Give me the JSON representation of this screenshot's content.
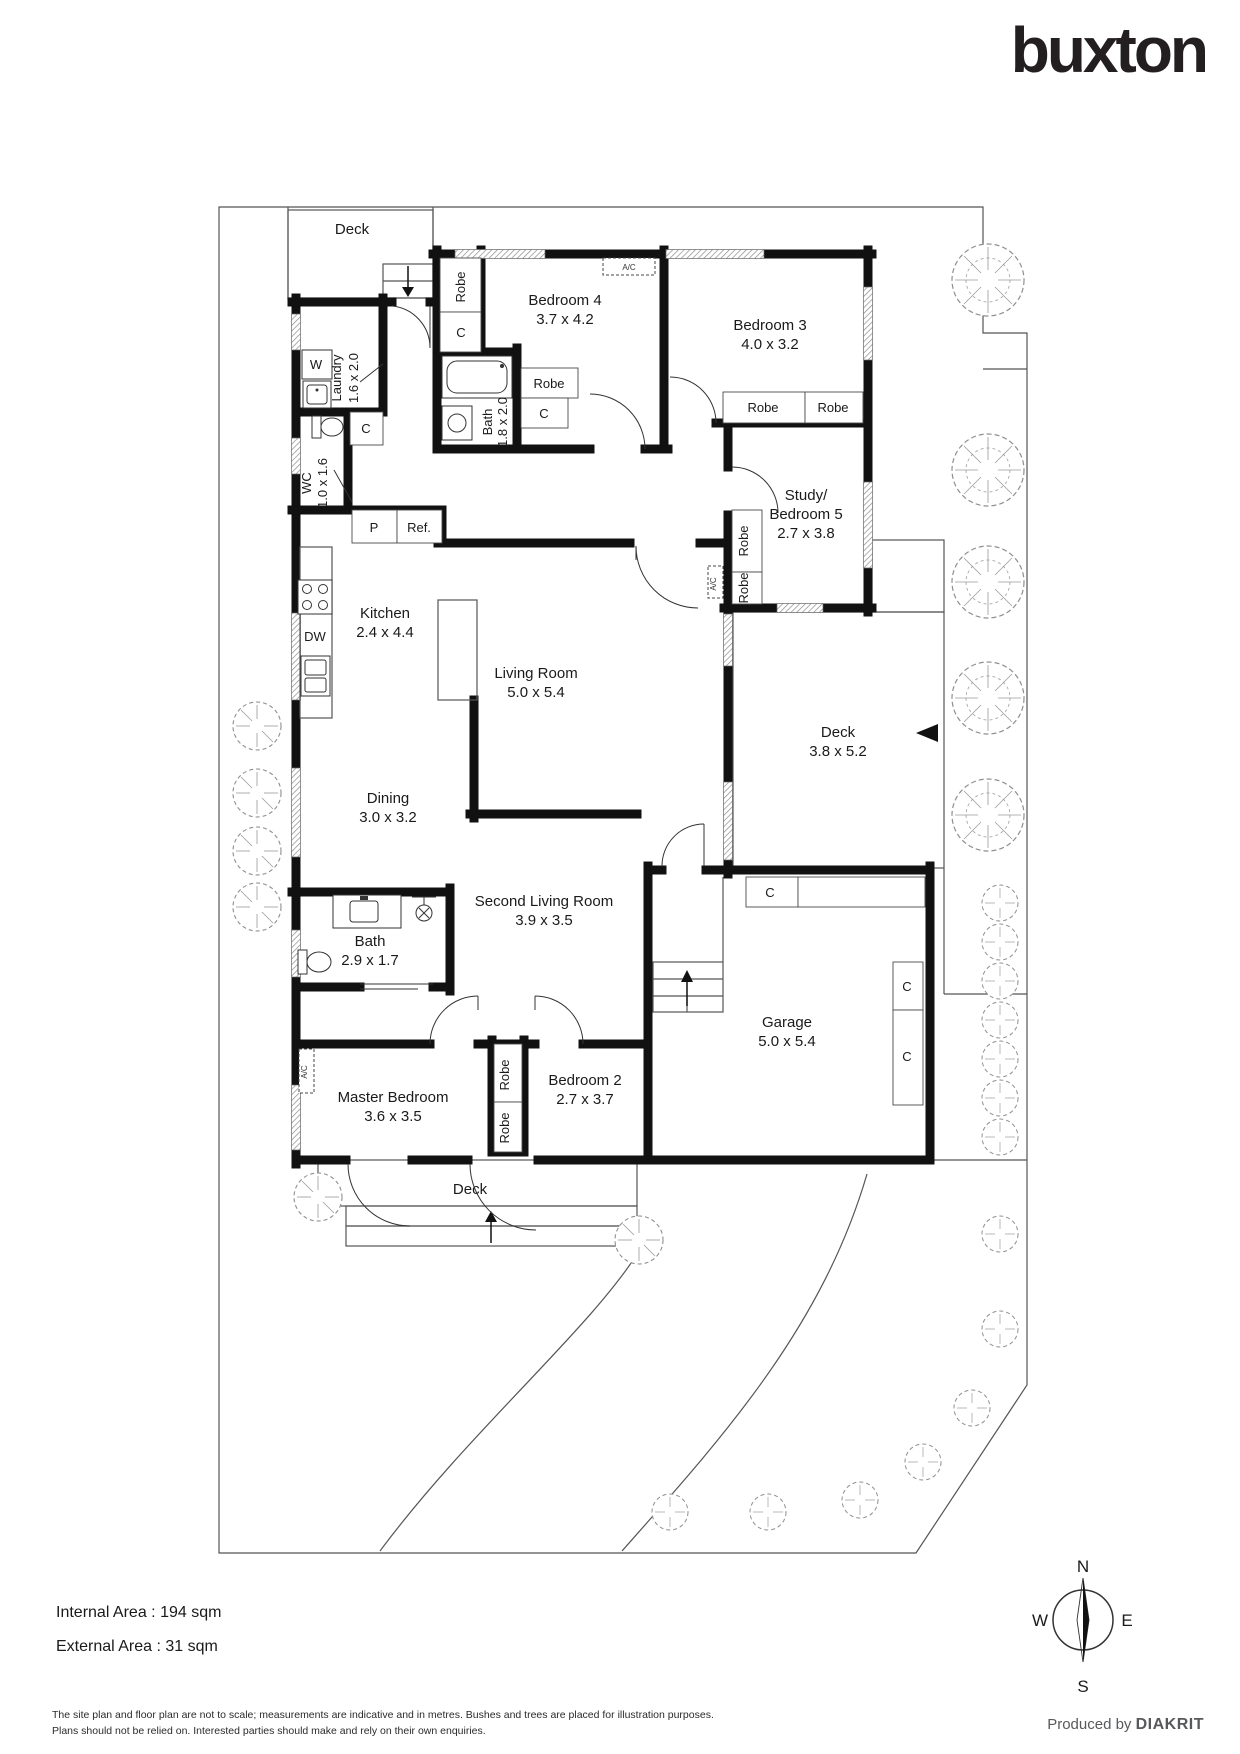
{
  "brand": {
    "logo_text": "buxton"
  },
  "labels": {
    "robe": "Robe",
    "c": "C",
    "p": "P",
    "ref": "Ref.",
    "dw": "DW",
    "w": "W",
    "ac": "A/C"
  },
  "rooms": {
    "deck_top": {
      "name": "Deck"
    },
    "laundry": {
      "name": "Laundry",
      "dims": "1.6 x 2.0"
    },
    "wc": {
      "name": "WC",
      "dims": "1.0 x 1.6"
    },
    "bath_top": {
      "name": "Bath",
      "dims": "1.8 x 2.0"
    },
    "bedroom4": {
      "name": "Bedroom 4",
      "dims": "3.7 x 4.2"
    },
    "bedroom3": {
      "name": "Bedroom 3",
      "dims": "4.0 x 3.2"
    },
    "study": {
      "name": "Study/",
      "name2": "Bedroom 5",
      "dims": "2.7 x 3.8"
    },
    "kitchen": {
      "name": "Kitchen",
      "dims": "2.4 x 4.4"
    },
    "living": {
      "name": "Living Room",
      "dims": "5.0 x 5.4"
    },
    "deck_right": {
      "name": "Deck",
      "dims": "3.8 x 5.2"
    },
    "dining": {
      "name": "Dining",
      "dims": "3.0 x 3.2"
    },
    "second_living": {
      "name": "Second Living Room",
      "dims": "3.9 x 3.5"
    },
    "bath_lower": {
      "name": "Bath",
      "dims": "2.9 x 1.7"
    },
    "master": {
      "name": "Master Bedroom",
      "dims": "3.6 x 3.5"
    },
    "bedroom2": {
      "name": "Bedroom 2",
      "dims": "2.7 x 3.7"
    },
    "garage": {
      "name": "Garage",
      "dims": "5.0 x 5.4"
    },
    "deck_bottom": {
      "name": "Deck"
    }
  },
  "compass": {
    "north": "N",
    "south": "S",
    "east": "E",
    "west": "W"
  },
  "footer": {
    "internal_area": "Internal Area : 194 sqm",
    "external_area": "External Area : 31 sqm",
    "disclaimer_line1": "The site plan and floor plan are not to scale; measurements are indicative and in metres. Bushes and trees are placed for illustration purposes.",
    "disclaimer_line2": "Plans should not be relied on. Interested parties should make and rely on their own enquiries.",
    "produced_by": "Produced by",
    "producer": "DIAKRIT"
  },
  "colors": {
    "wall": "#111111",
    "line": "#555555",
    "tree": "#8f8f8f",
    "logo": "#231f20",
    "producer": "#58595b"
  }
}
